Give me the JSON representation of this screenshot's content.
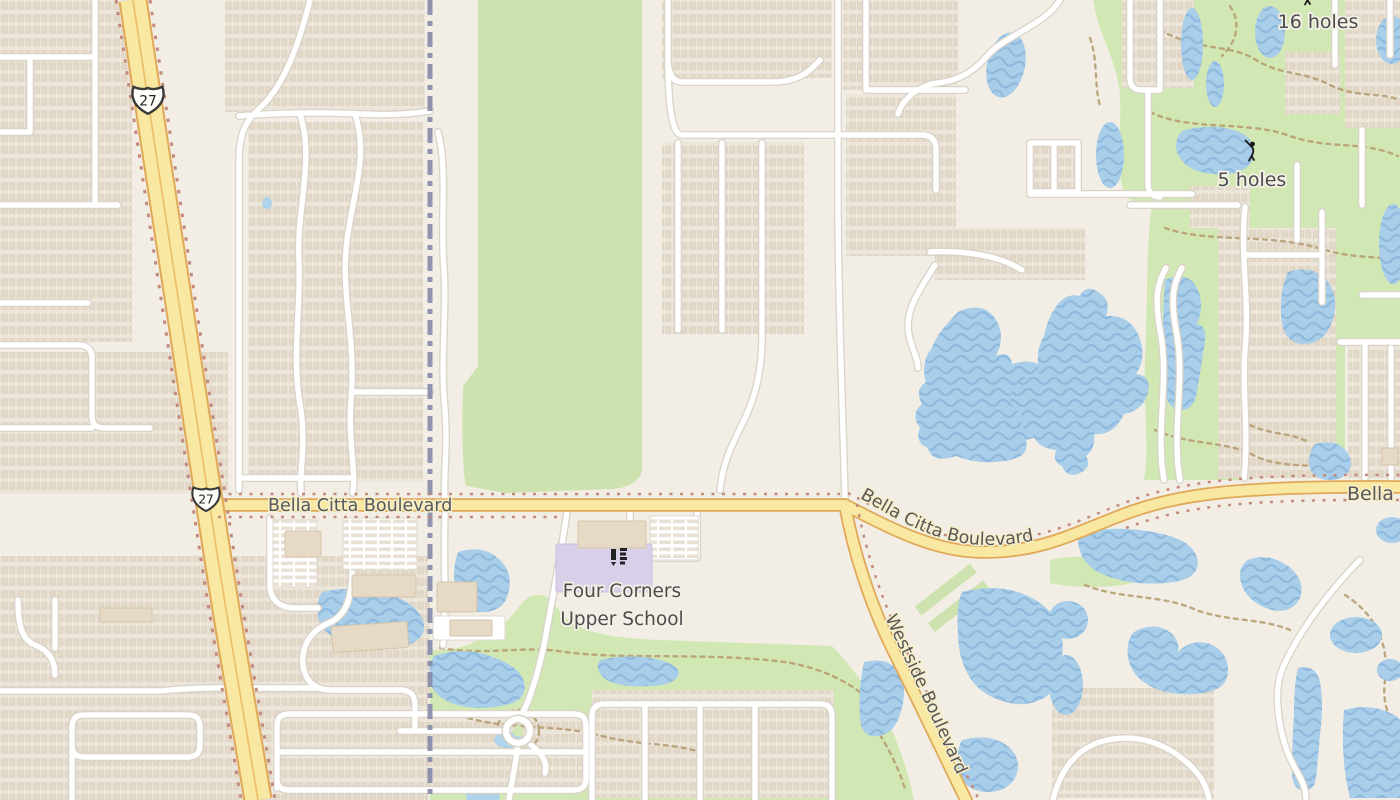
{
  "map": {
    "labels": {
      "holes16": "16 holes",
      "holes5": "5 holes",
      "school_line1": "Four Corners",
      "school_line2": "Upper School",
      "bella_citta_west": "Bella Citta Boulevard",
      "bella_citta_east": "Bella Citta Boulevard",
      "bella_citta_edge": "Bella",
      "westside": "Westside Boulevard",
      "route27": "27"
    },
    "icons": {
      "golfer": "golfer-icon",
      "school": "school-icon",
      "route_shield": "us-route-27-shield"
    },
    "colors": {
      "land": "#f2eee5",
      "residential": "#ece5da",
      "house": "#e3d8c8",
      "road_white": "#ffffff",
      "road_casing": "#d9d3c9",
      "highway_fill": "#f8e8a2",
      "highway_casing": "#e0a857",
      "construction_dots": "#c4897b",
      "water": "#a8cee9",
      "water_wave": "#8fb9dd",
      "green_golf": "#d2e8b4",
      "green_field": "#cde2ae",
      "golf_path": "#b49b6f",
      "boundary": "#8589a9",
      "school_grounds": "#d9cfe9",
      "building": "#e6d9c6",
      "label_text": "#4c4c4c",
      "road_label_text": "#575757"
    }
  }
}
